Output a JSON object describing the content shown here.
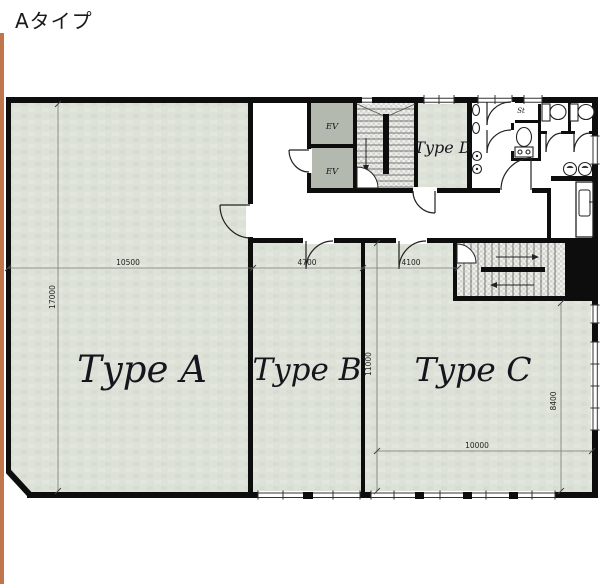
{
  "page": {
    "title": "Aタイプ"
  },
  "plan": {
    "rooms": [
      {
        "label": "Type A"
      },
      {
        "label": "Type B"
      },
      {
        "label": "Type C"
      },
      {
        "label": "Type D"
      }
    ],
    "elevators": [
      "EV",
      "EV"
    ],
    "storage_label": "St",
    "dimensions": {
      "a_width": "10500",
      "a_height": "17000",
      "b_width": "4700",
      "c_entry": "4100",
      "bc_height": "11000",
      "c_height": "8400",
      "c_width": "10000"
    },
    "colors": {
      "accent_stripe": "#c0754a",
      "wall": "#0d0d0d",
      "room_fill": "#dde2d8",
      "elevator_fill": "#b4b9b0"
    }
  }
}
